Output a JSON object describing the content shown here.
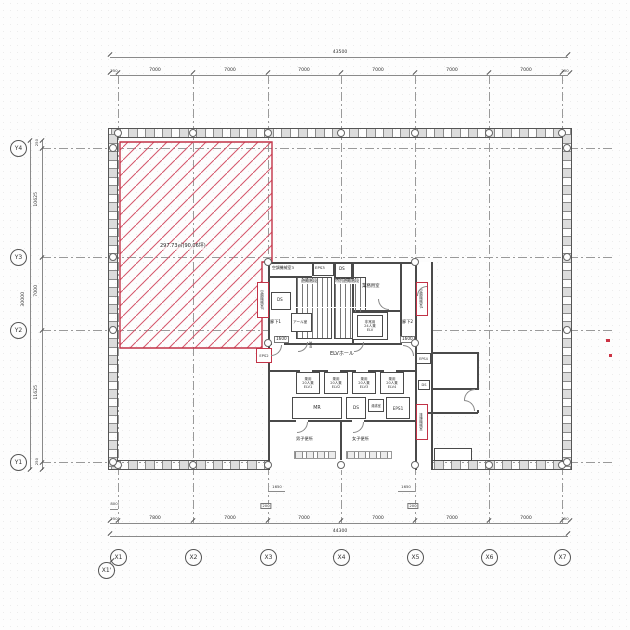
{
  "plan_title": "office-floor-plan",
  "accent_color": "#c23347",
  "axes": {
    "x": [
      "X1",
      "X2",
      "X3",
      "X4",
      "X5",
      "X6",
      "X7"
    ],
    "x_prime": "X1'",
    "y": [
      "Y4",
      "Y3",
      "Y2",
      "Y1"
    ]
  },
  "dims": {
    "top_total": "43500",
    "top_segs": [
      "250",
      "7000",
      "7000",
      "7000",
      "7000",
      "7000",
      "7000",
      "250"
    ],
    "bottom_total": "44300",
    "bottom_segs": [
      "250",
      "7800",
      "7000",
      "7000",
      "7000",
      "7000",
      "7000",
      "250"
    ],
    "left_total": "30000",
    "left_segs": [
      "250",
      "10625",
      "7000",
      "11625",
      "250"
    ],
    "offset_800": "800",
    "sub_1650_a": "1650",
    "sub_1650_b": "1650",
    "sub_200_a": "200",
    "sub_200_b": "200",
    "hall_1600_l": "1600",
    "hall_1600_r": "1600",
    "hall_300": "300"
  },
  "area_zone": {
    "label": "297.73㎡(90.06坪)"
  },
  "rooms": {
    "ac3": "空調機械室3",
    "eps3": "EPS3",
    "ds_top": "DS",
    "ds_left": "DS",
    "stair1": "避難階段",
    "stair2": "特別避難階段",
    "gyomu": "業務用室",
    "em1": "非常用",
    "em2": "24人乗",
    "em3": "ELV",
    "rouka1": "廊下1",
    "rouka2": "廊下2",
    "aaru": "アール室",
    "ac2": "空調機械室2",
    "eps2": "EPS2",
    "ac1": "空調機械室1",
    "haien": "排煙機械室",
    "eps4": "EPS4",
    "ds_e": "DS",
    "elv_hall": "ELVホール",
    "elv_use": "乗用",
    "elv_cap": "20人乗",
    "elv1": "ELV1",
    "elv2": "ELV2",
    "elv3": "ELV3",
    "elv4": "ELV4",
    "mr": "MR",
    "ds_mid": "DS",
    "yuwakashi": "湯沸室",
    "eps1": "EPS1",
    "wc_m": "男子便所",
    "wc_f": "女子便所"
  }
}
